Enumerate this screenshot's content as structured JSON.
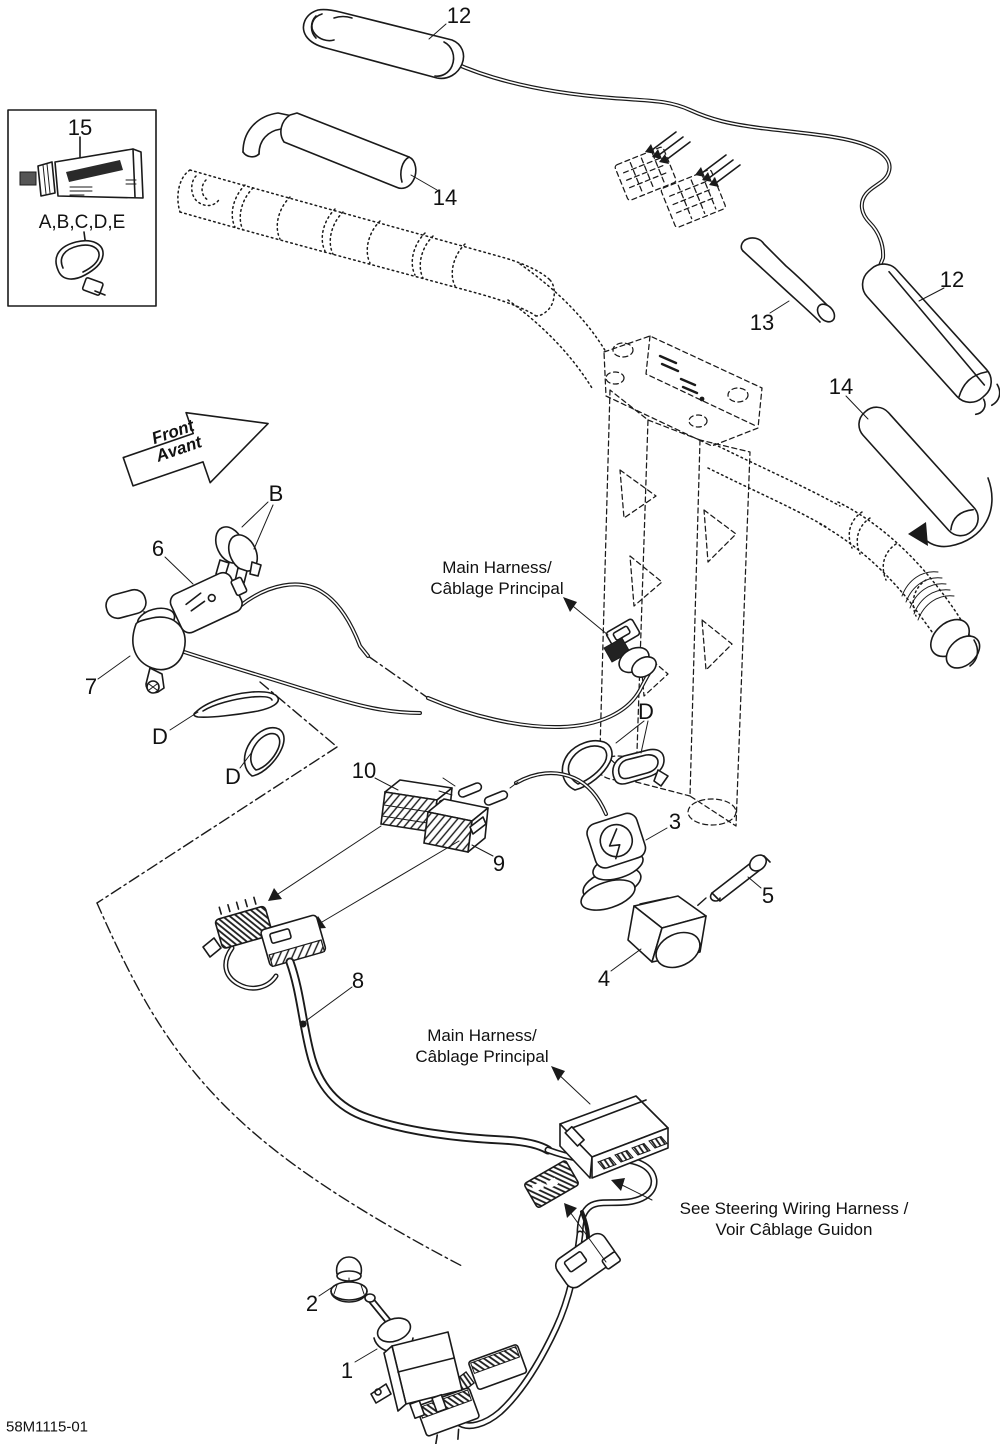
{
  "colors": {
    "line": "#1a1a1a",
    "background": "#ffffff"
  },
  "footer": {
    "drawing_number": "58M1115-01"
  },
  "callouts": {
    "c15": "15",
    "abcde": "A,B,C,D,E",
    "c12_top": "12",
    "c14_top": "14",
    "c13": "13",
    "c12_right": "12",
    "c14_right": "14",
    "cB": "B",
    "c6": "6",
    "c7": "7",
    "cD_left1": "D",
    "cD_left2": "D",
    "cD_right": "D",
    "c10": "10",
    "c9": "9",
    "c3": "3",
    "c5": "5",
    "c4": "4",
    "c8": "8",
    "c2": "2",
    "c1": "1"
  },
  "annotations": {
    "main_harness_top": {
      "line1": "Main Harness/",
      "line2": "Câblage Principal"
    },
    "main_harness_bottom": {
      "line1": "Main Harness/",
      "line2": "Câblage Principal"
    },
    "see_steering": {
      "line1": "See Steering Wiring Harness /",
      "line2": "Voir Câblage Guidon"
    },
    "front_arrow": {
      "line1": "Front",
      "line2": "Avant"
    }
  }
}
